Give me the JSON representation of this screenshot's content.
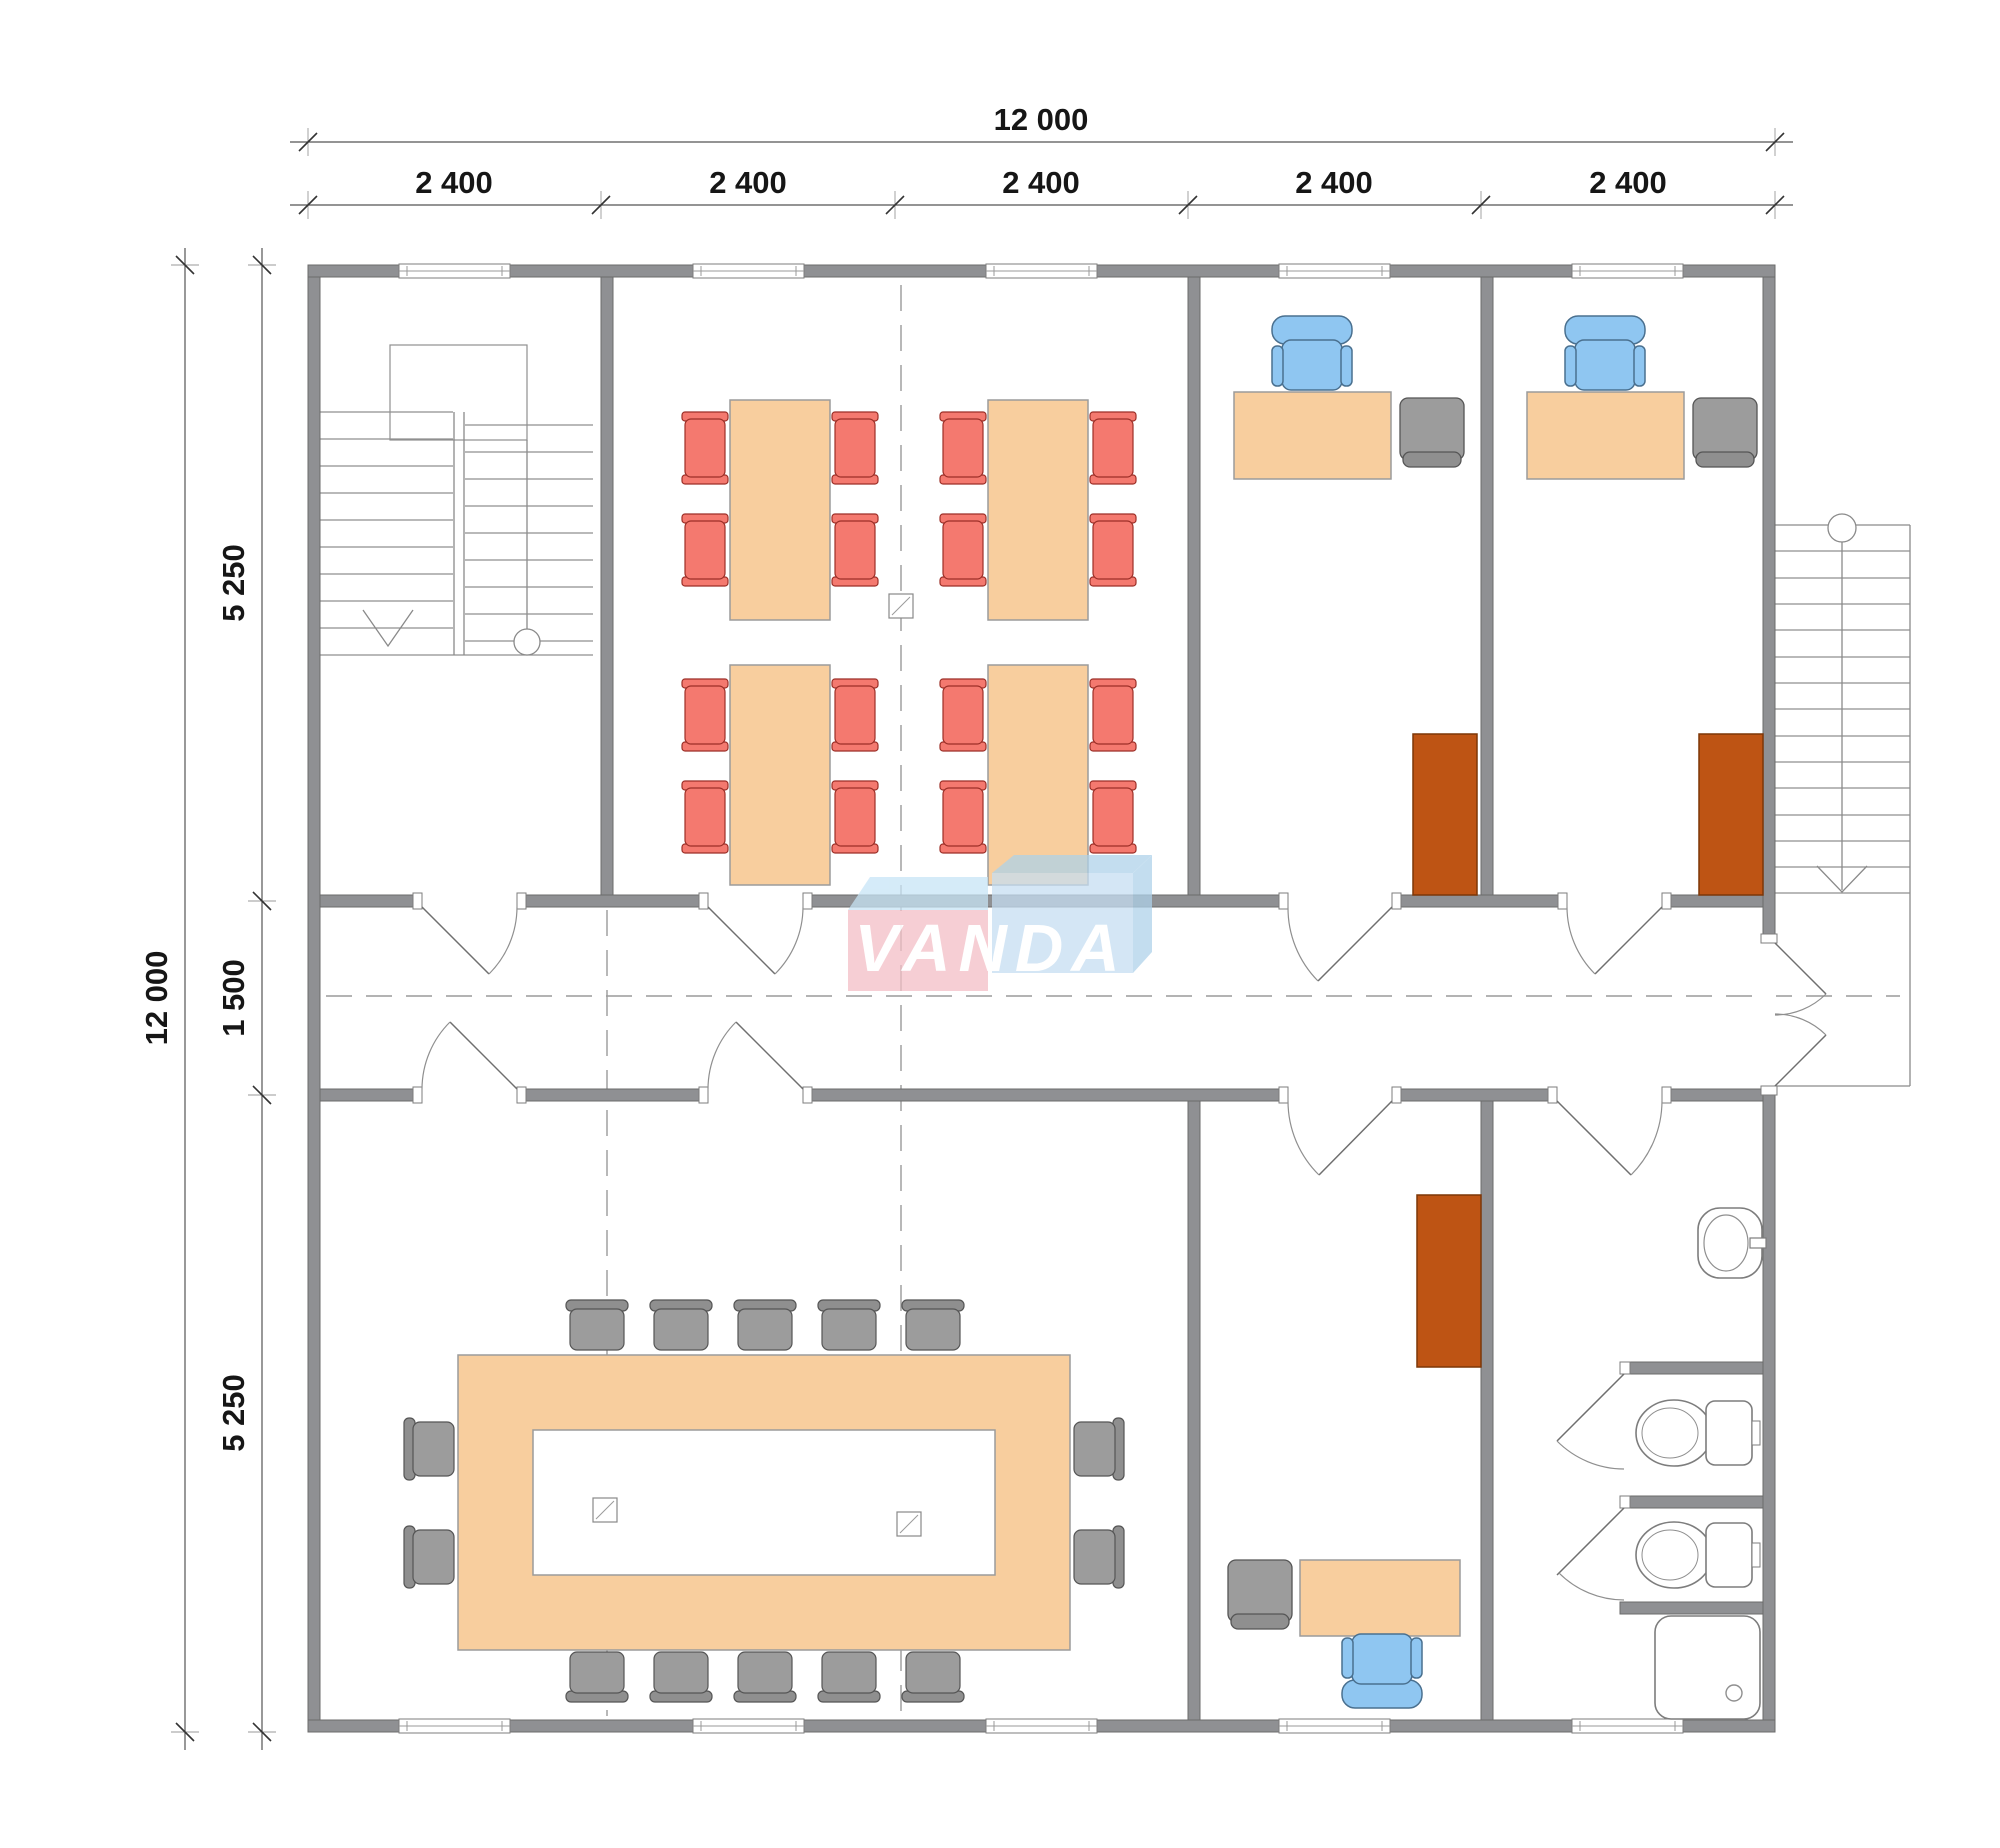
{
  "logo": {
    "text": "VANDA"
  },
  "dimensions": {
    "top_total": "12 000",
    "top_segments": [
      "2 400",
      "2 400",
      "2 400",
      "2 400",
      "2 400"
    ],
    "left_total": "12 000",
    "left_segments": [
      "5 250",
      "1 500",
      "5 250"
    ]
  },
  "colors": {
    "wall": "#8F9093",
    "table": "#F8CE9E",
    "chair_red": "#F4796F",
    "chair_blue": "#8FC6F1",
    "chair_gray": "#9C9C9C",
    "cabinet": "#BE5414",
    "logo_pink": "#F3BEC5",
    "logo_blue": "#C6DFF2"
  },
  "inventory": {
    "classroom": {
      "tables": 4,
      "red_chairs": 16
    },
    "offices_top": {
      "count": 2,
      "desks": 2,
      "task_chairs": 2,
      "guest_chairs": 2,
      "cabinets": 2
    },
    "conference_room": {
      "tables": 1,
      "gray_chairs": 14,
      "columns": 2
    },
    "office_bottom": {
      "desks": 1,
      "task_chairs": 1,
      "guest_chairs": 1,
      "cabinets": 1
    },
    "bathroom": {
      "sinks": 1,
      "toilets": 2,
      "showers": 1
    },
    "stairs": {
      "internal": 1,
      "external": 1
    }
  }
}
